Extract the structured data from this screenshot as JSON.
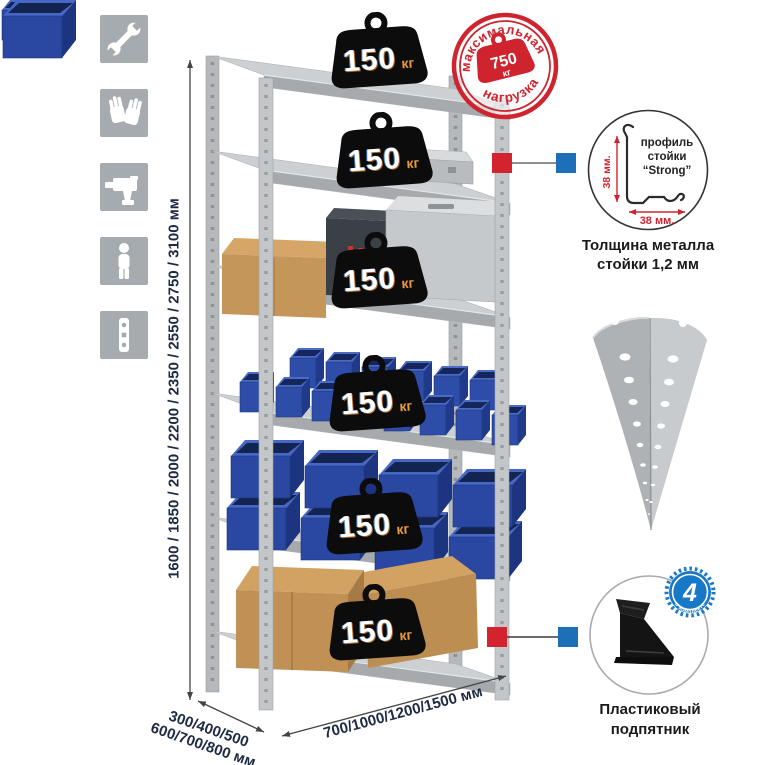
{
  "colors": {
    "accent_red": "#d2232f",
    "accent_blue": "#1d70b8",
    "navy_text": "#1d2a44",
    "icon_gray": "#a6abaf",
    "bin_blue": "#2d4da8",
    "metal_gray": "#c3c7ca"
  },
  "sidebar_icons": [
    {
      "name": "wrench-icon"
    },
    {
      "name": "gloves-icon"
    },
    {
      "name": "drill-icon"
    },
    {
      "name": "person-icon"
    },
    {
      "name": "perforated-profile-icon"
    }
  ],
  "dimensions": {
    "height": "1600 / 1850 / 2000 / 2200 / 2350 / 2550 / 2750 / 3100 мм",
    "depth_line1": "300/400/500",
    "depth_line2": "600/700/800 мм",
    "width": "700/1000/1200/1500 мм"
  },
  "stamp": {
    "arc_top": "максимальная",
    "arc_bottom": "нагрузка",
    "value": "750",
    "unit": "кг"
  },
  "shelves": [
    {
      "load": "150",
      "unit": "кг"
    },
    {
      "load": "150",
      "unit": "кг"
    },
    {
      "load": "150",
      "unit": "кг"
    },
    {
      "load": "150",
      "unit": "кг"
    },
    {
      "load": "150",
      "unit": "кг"
    },
    {
      "load": "150",
      "unit": "кг"
    }
  ],
  "profile_detail": {
    "line1": "профиль",
    "line2": "стойки",
    "line3": "“Strong”",
    "dim_vertical": "38 мм.",
    "dim_horizontal": "38 мм."
  },
  "thickness": {
    "line1": "Толщина металла",
    "line2": "стойки 1,2 мм"
  },
  "foot": {
    "badge_value": "4",
    "badge_label": "в комплекте",
    "caption_line1": "Пластиковый",
    "caption_line2": "подпятник"
  }
}
